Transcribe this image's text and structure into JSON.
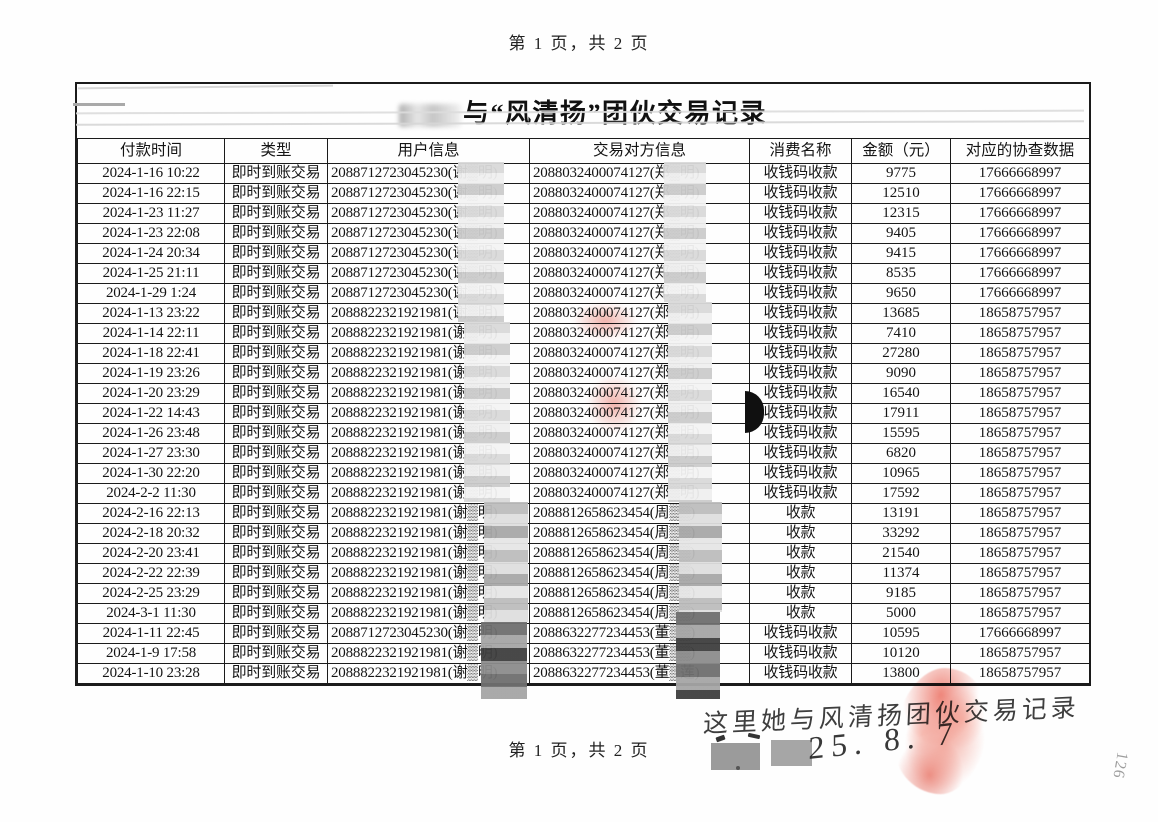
{
  "page": {
    "header_pagination": "第 1 页，共 2 页",
    "footer_pagination": "第 1 页，共 2 页",
    "corner_mark": "126"
  },
  "table": {
    "title": "与“风清扬”团伙交易记录",
    "columns": [
      "付款时间",
      "类型",
      "用户信息",
      "交易对方信息",
      "消费名称",
      "金额（元）",
      "对应的协查数据"
    ],
    "rows": [
      [
        "2024-1-16 10:22",
        "即时到账交易",
        "2088712723045230(谢▒明)",
        "2088032400074127(郑▒明)",
        "收钱码收款",
        "9775",
        "17666668997"
      ],
      [
        "2024-1-16 22:15",
        "即时到账交易",
        "2088712723045230(谢▒明)",
        "2088032400074127(郑▒明)",
        "收钱码收款",
        "12510",
        "17666668997"
      ],
      [
        "2024-1-23 11:27",
        "即时到账交易",
        "2088712723045230(谢▒明)",
        "2088032400074127(郑▒明)",
        "收钱码收款",
        "12315",
        "17666668997"
      ],
      [
        "2024-1-23 22:08",
        "即时到账交易",
        "2088712723045230(谢▒明)",
        "2088032400074127(郑▒明)",
        "收钱码收款",
        "9405",
        "17666668997"
      ],
      [
        "2024-1-24 20:34",
        "即时到账交易",
        "2088712723045230(谢▒明)",
        "2088032400074127(郑▒明)",
        "收钱码收款",
        "9415",
        "17666668997"
      ],
      [
        "2024-1-25 21:11",
        "即时到账交易",
        "2088712723045230(谢▒明)",
        "2088032400074127(郑▒明)",
        "收钱码收款",
        "8535",
        "17666668997"
      ],
      [
        "2024-1-29 1:24",
        "即时到账交易",
        "2088712723045230(谢▒明)",
        "2088032400074127(郑▒明)",
        "收钱码收款",
        "9650",
        "17666668997"
      ],
      [
        "2024-1-13 23:22",
        "即时到账交易",
        "2088822321921981(谢▒明)",
        "2088032400074127(郑▒明)",
        "收钱码收款",
        "13685",
        "18658757957"
      ],
      [
        "2024-1-14 22:11",
        "即时到账交易",
        "2088822321921981(谢▒明)",
        "2088032400074127(郑▒明)",
        "收钱码收款",
        "7410",
        "18658757957"
      ],
      [
        "2024-1-18 22:41",
        "即时到账交易",
        "2088822321921981(谢▒明)",
        "2088032400074127(郑▒明)",
        "收钱码收款",
        "27280",
        "18658757957"
      ],
      [
        "2024-1-19 23:26",
        "即时到账交易",
        "2088822321921981(谢▒明)",
        "2088032400074127(郑▒明)",
        "收钱码收款",
        "9090",
        "18658757957"
      ],
      [
        "2024-1-20 23:29",
        "即时到账交易",
        "2088822321921981(谢▒明)",
        "2088032400074127(郑▒明)",
        "收钱码收款",
        "16540",
        "18658757957"
      ],
      [
        "2024-1-22 14:43",
        "即时到账交易",
        "2088822321921981(谢▒明)",
        "2088032400074127(郑▒明)",
        "收钱码收款",
        "17911",
        "18658757957"
      ],
      [
        "2024-1-26 23:48",
        "即时到账交易",
        "2088822321921981(谢▒明)",
        "2088032400074127(郑▒明)",
        "收钱码收款",
        "15595",
        "18658757957"
      ],
      [
        "2024-1-27 23:30",
        "即时到账交易",
        "2088822321921981(谢▒明)",
        "2088032400074127(郑▒明)",
        "收钱码收款",
        "6820",
        "18658757957"
      ],
      [
        "2024-1-30 22:20",
        "即时到账交易",
        "2088822321921981(谢▒明)",
        "2088032400074127(郑▒明)",
        "收钱码收款",
        "10965",
        "18658757957"
      ],
      [
        "2024-2-2 11:30",
        "即时到账交易",
        "2088822321921981(谢▒明)",
        "2088032400074127(郑▒明)",
        "收钱码收款",
        "17592",
        "18658757957"
      ],
      [
        "2024-2-16 22:13",
        "即时到账交易",
        "2088822321921981(谢▒明)",
        "2088812658623454(周▒▒)",
        "收款",
        "13191",
        "18658757957"
      ],
      [
        "2024-2-18 20:32",
        "即时到账交易",
        "2088822321921981(谢▒明)",
        "2088812658623454(周▒▒)",
        "收款",
        "33292",
        "18658757957"
      ],
      [
        "2024-2-20 23:41",
        "即时到账交易",
        "2088822321921981(谢▒明)",
        "2088812658623454(周▒▒)",
        "收款",
        "21540",
        "18658757957"
      ],
      [
        "2024-2-22 22:39",
        "即时到账交易",
        "2088822321921981(谢▒明)",
        "2088812658623454(周▒▒)",
        "收款",
        "11374",
        "18658757957"
      ],
      [
        "2024-2-25 23:29",
        "即时到账交易",
        "2088822321921981(谢▒明)",
        "2088812658623454(周▒▒)",
        "收款",
        "9185",
        "18658757957"
      ],
      [
        "2024-3-1 11:30",
        "即时到账交易",
        "2088822321921981(谢▒明)",
        "2088812658623454(周▒▒)",
        "收款",
        "5000",
        "18658757957"
      ],
      [
        "2024-1-11 22:45",
        "即时到账交易",
        "2088712723045230(谢▒明)",
        "2088632277234453(董▒▒)",
        "收钱码收款",
        "10595",
        "17666668997"
      ],
      [
        "2024-1-9 17:58",
        "即时到账交易",
        "2088822321921981(谢▒明)",
        "2088632277234453(董▒▒)",
        "收钱码收款",
        "10120",
        "18658757957"
      ],
      [
        "2024-1-10 23:28",
        "即时到账交易",
        "2088822321921981(谢▒明)",
        "2088632277234453(董▒莲)",
        "收钱码收款",
        "13800",
        "18658757957"
      ]
    ]
  },
  "annotations": {
    "handwritten_note": "这里她与风清扬团伙交易记录",
    "handwritten_date": "25. 8. 7",
    "fingerprint_color": "#e2604f"
  }
}
